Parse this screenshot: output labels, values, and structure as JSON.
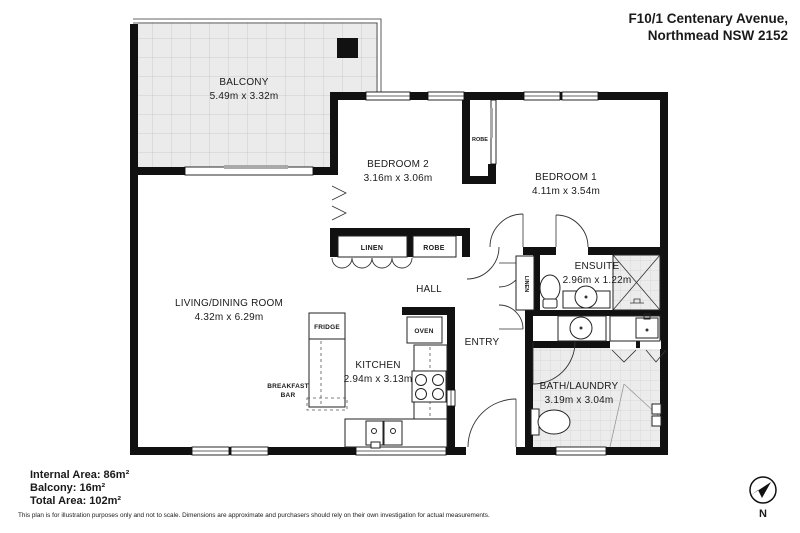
{
  "header": {
    "address_line1": "F10/1 Centenary Avenue,",
    "address_line2": "Northmead NSW 2152"
  },
  "rooms": {
    "balcony": {
      "name": "BALCONY",
      "dims": "5.49m x 3.32m"
    },
    "bedroom2": {
      "name": "BEDROOM 2",
      "dims": "3.16m x 3.06m"
    },
    "bedroom1": {
      "name": "BEDROOM 1",
      "dims": "4.11m x 3.54m"
    },
    "ensuite": {
      "name": "ENSUITE",
      "dims": "2.96m x 1.22m"
    },
    "living_dining": {
      "name": "LIVING/DINING ROOM",
      "dims": "4.32m x 6.29m"
    },
    "kitchen": {
      "name": "KITCHEN",
      "dims": "2.94m x 3.13m"
    },
    "bath_laundry": {
      "name": "BATH/LAUNDRY",
      "dims": "3.19m x 3.04m"
    },
    "hall": {
      "name": "HALL"
    },
    "entry": {
      "name": "ENTRY"
    }
  },
  "storage": {
    "hall_linen": "LINEN",
    "hall_robe": "ROBE",
    "bedroom_robe": "ROBE",
    "entry_linen": "LINEN"
  },
  "kitchen_items": {
    "fridge": "FRIDGE",
    "oven": "OVEN",
    "breakfast_bar_line1": "BREAKFAST",
    "breakfast_bar_line2": "BAR"
  },
  "footer": {
    "internal_area": "Internal Area: 86m²",
    "balcony_area": "Balcony: 16m²",
    "total_area": "Total Area: 102m²",
    "disclaimer": "This plan is for illustration purposes only and not to scale. Dimensions are approximate and purchasers should rely on their own investigation for actual measurements."
  },
  "compass": {
    "north_label": "N"
  },
  "colors": {
    "wall": "#111111",
    "balcony_tile_fill": "#ebebeb",
    "tile_line": "#cccccc",
    "bath_tile_fill": "#ececec",
    "text": "#1a1a1a"
  }
}
